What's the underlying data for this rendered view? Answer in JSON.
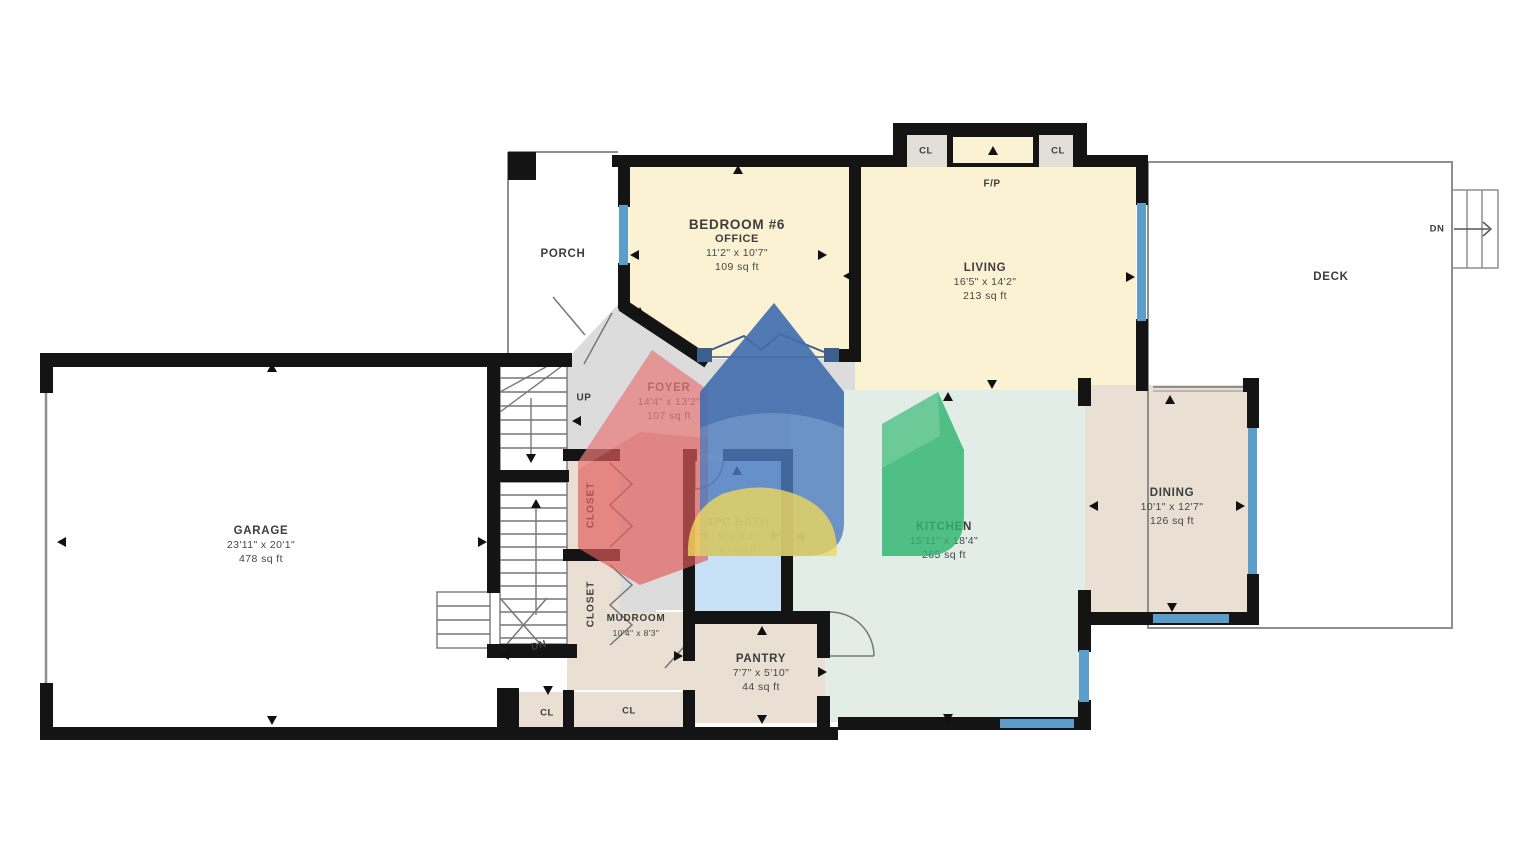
{
  "rooms": {
    "porch": {
      "name": "PORCH"
    },
    "bedroom": {
      "name": "BEDROOM #6",
      "alt_name": "OFFICE",
      "dims": "11'2\" x 10'7\"",
      "area": "109 sq ft"
    },
    "living": {
      "name": "LIVING",
      "dims": "16'5\" x 14'2\"",
      "area": "213 sq ft"
    },
    "deck": {
      "name": "DECK"
    },
    "foyer": {
      "name": "FOYER",
      "dims": "14'4\" x 13'2\"",
      "area": "107 sq ft"
    },
    "garage": {
      "name": "GARAGE",
      "dims": "23'11\" x 20'1\"",
      "area": "478 sq ft"
    },
    "bath": {
      "name": "4PC BATH",
      "dims": "5' x 8'4\"",
      "area": "42 sq ft"
    },
    "kitchen": {
      "name": "KITCHEN",
      "dims": "15'11\" x 18'4\"",
      "area": "265 sq ft"
    },
    "dining": {
      "name": "DINING",
      "dims": "10'1\" x 12'7\"",
      "area": "126 sq ft"
    },
    "mudroom": {
      "name": "MUDROOM",
      "dims": "10'4\" x 8'3\""
    },
    "pantry": {
      "name": "PANTRY",
      "dims": "7'7\" x 5'10\"",
      "area": "44 sq ft"
    },
    "closet_upper": {
      "name": "CLOSET"
    },
    "closet_lower": {
      "name": "CLOSET"
    }
  },
  "annotations": {
    "fireplace": "F/P",
    "closet_abbr": "CL",
    "stairs_up": "UP",
    "stairs_down": "DN"
  },
  "colors": {
    "wall": "#141414",
    "window": "#5C9DC9",
    "room_cream": "#FBF2D4",
    "room_beige": "#E9DFD2",
    "room_green": "#E2EDE7",
    "room_blue": "#C8E1F6",
    "room_gray": "#DCDCDC",
    "logo_red": "#E25B5B",
    "logo_blue": "#4E7CBE",
    "logo_green": "#2FB56F",
    "logo_yellow": "#EFD75E"
  }
}
